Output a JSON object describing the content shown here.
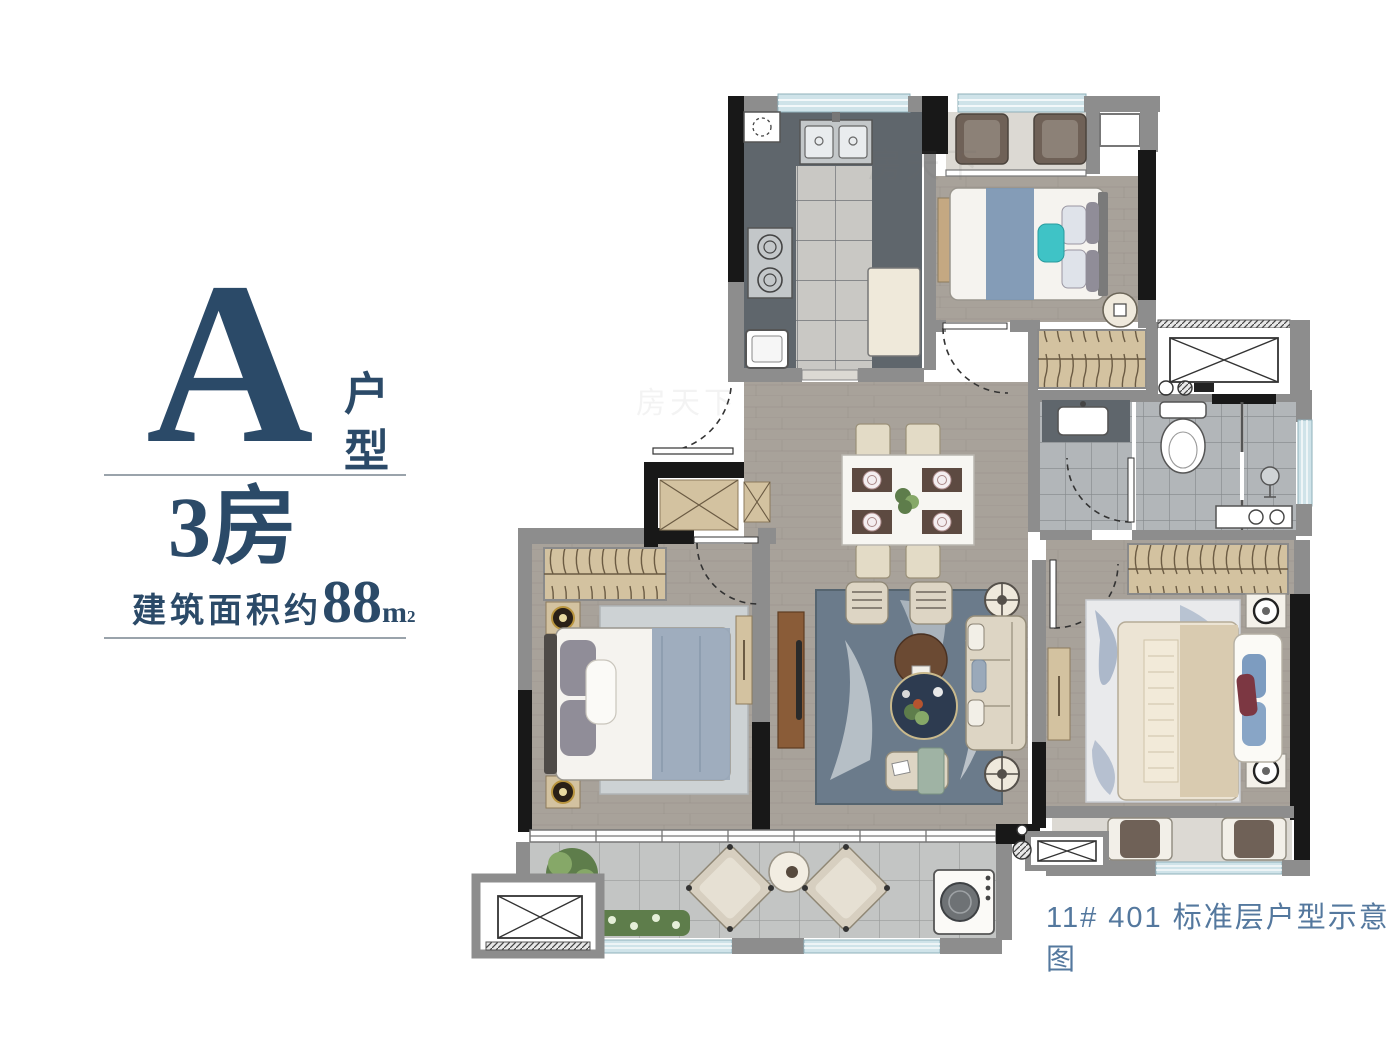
{
  "info_panel": {
    "unit_letter": "A",
    "unit_label": "户型",
    "rooms_label": "3房",
    "area_prefix": "建筑面积约",
    "area_value": "88",
    "area_unit": "m",
    "area_sup": "2"
  },
  "caption": {
    "text": "11# 401 标准层户型示意图"
  },
  "watermark": {
    "text": "房天下"
  },
  "colors": {
    "accent": "#2b4a68",
    "caption-color": "#54789e",
    "wall-dark": "#181818",
    "wall-gray": "#8d8d8d",
    "window": "#cfe3e9",
    "wood": "#a8a29a",
    "wood-line": "#8f8982",
    "kitchen-dark": "#5f666c",
    "tile-light": "#c9c8c4",
    "bath-tile": "#b2b6b9",
    "balc-tile": "#c3c5c4",
    "marble": "#dcd9d3",
    "tan": "#d3c2a0",
    "wood-brown": "#8a5c38",
    "rug-blue": "#6b7b8b",
    "rug-light": "#cdd2d4",
    "bed-white": "#f5f3ef",
    "bed-blue": "#7d97b3",
    "blanket": "#9aa9ba",
    "pillow": "#908d98",
    "teal": "#3fc3c6",
    "sofa": "#ddd5c4",
    "navy": "#2d3b50",
    "green": "#5e7d4b",
    "green-light": "#86a868",
    "red": "#7c3742",
    "cream": "#ece4d4",
    "steel": "#c3c7c9",
    "chair-brown": "#6f6157"
  },
  "floorplan": {
    "rooms": [
      "kitchen",
      "north-balcony",
      "bedroom-2",
      "bathroom",
      "dining-living",
      "master-bedroom",
      "bedroom-3",
      "south-balcony",
      "terrace",
      "ac-platforms"
    ]
  }
}
